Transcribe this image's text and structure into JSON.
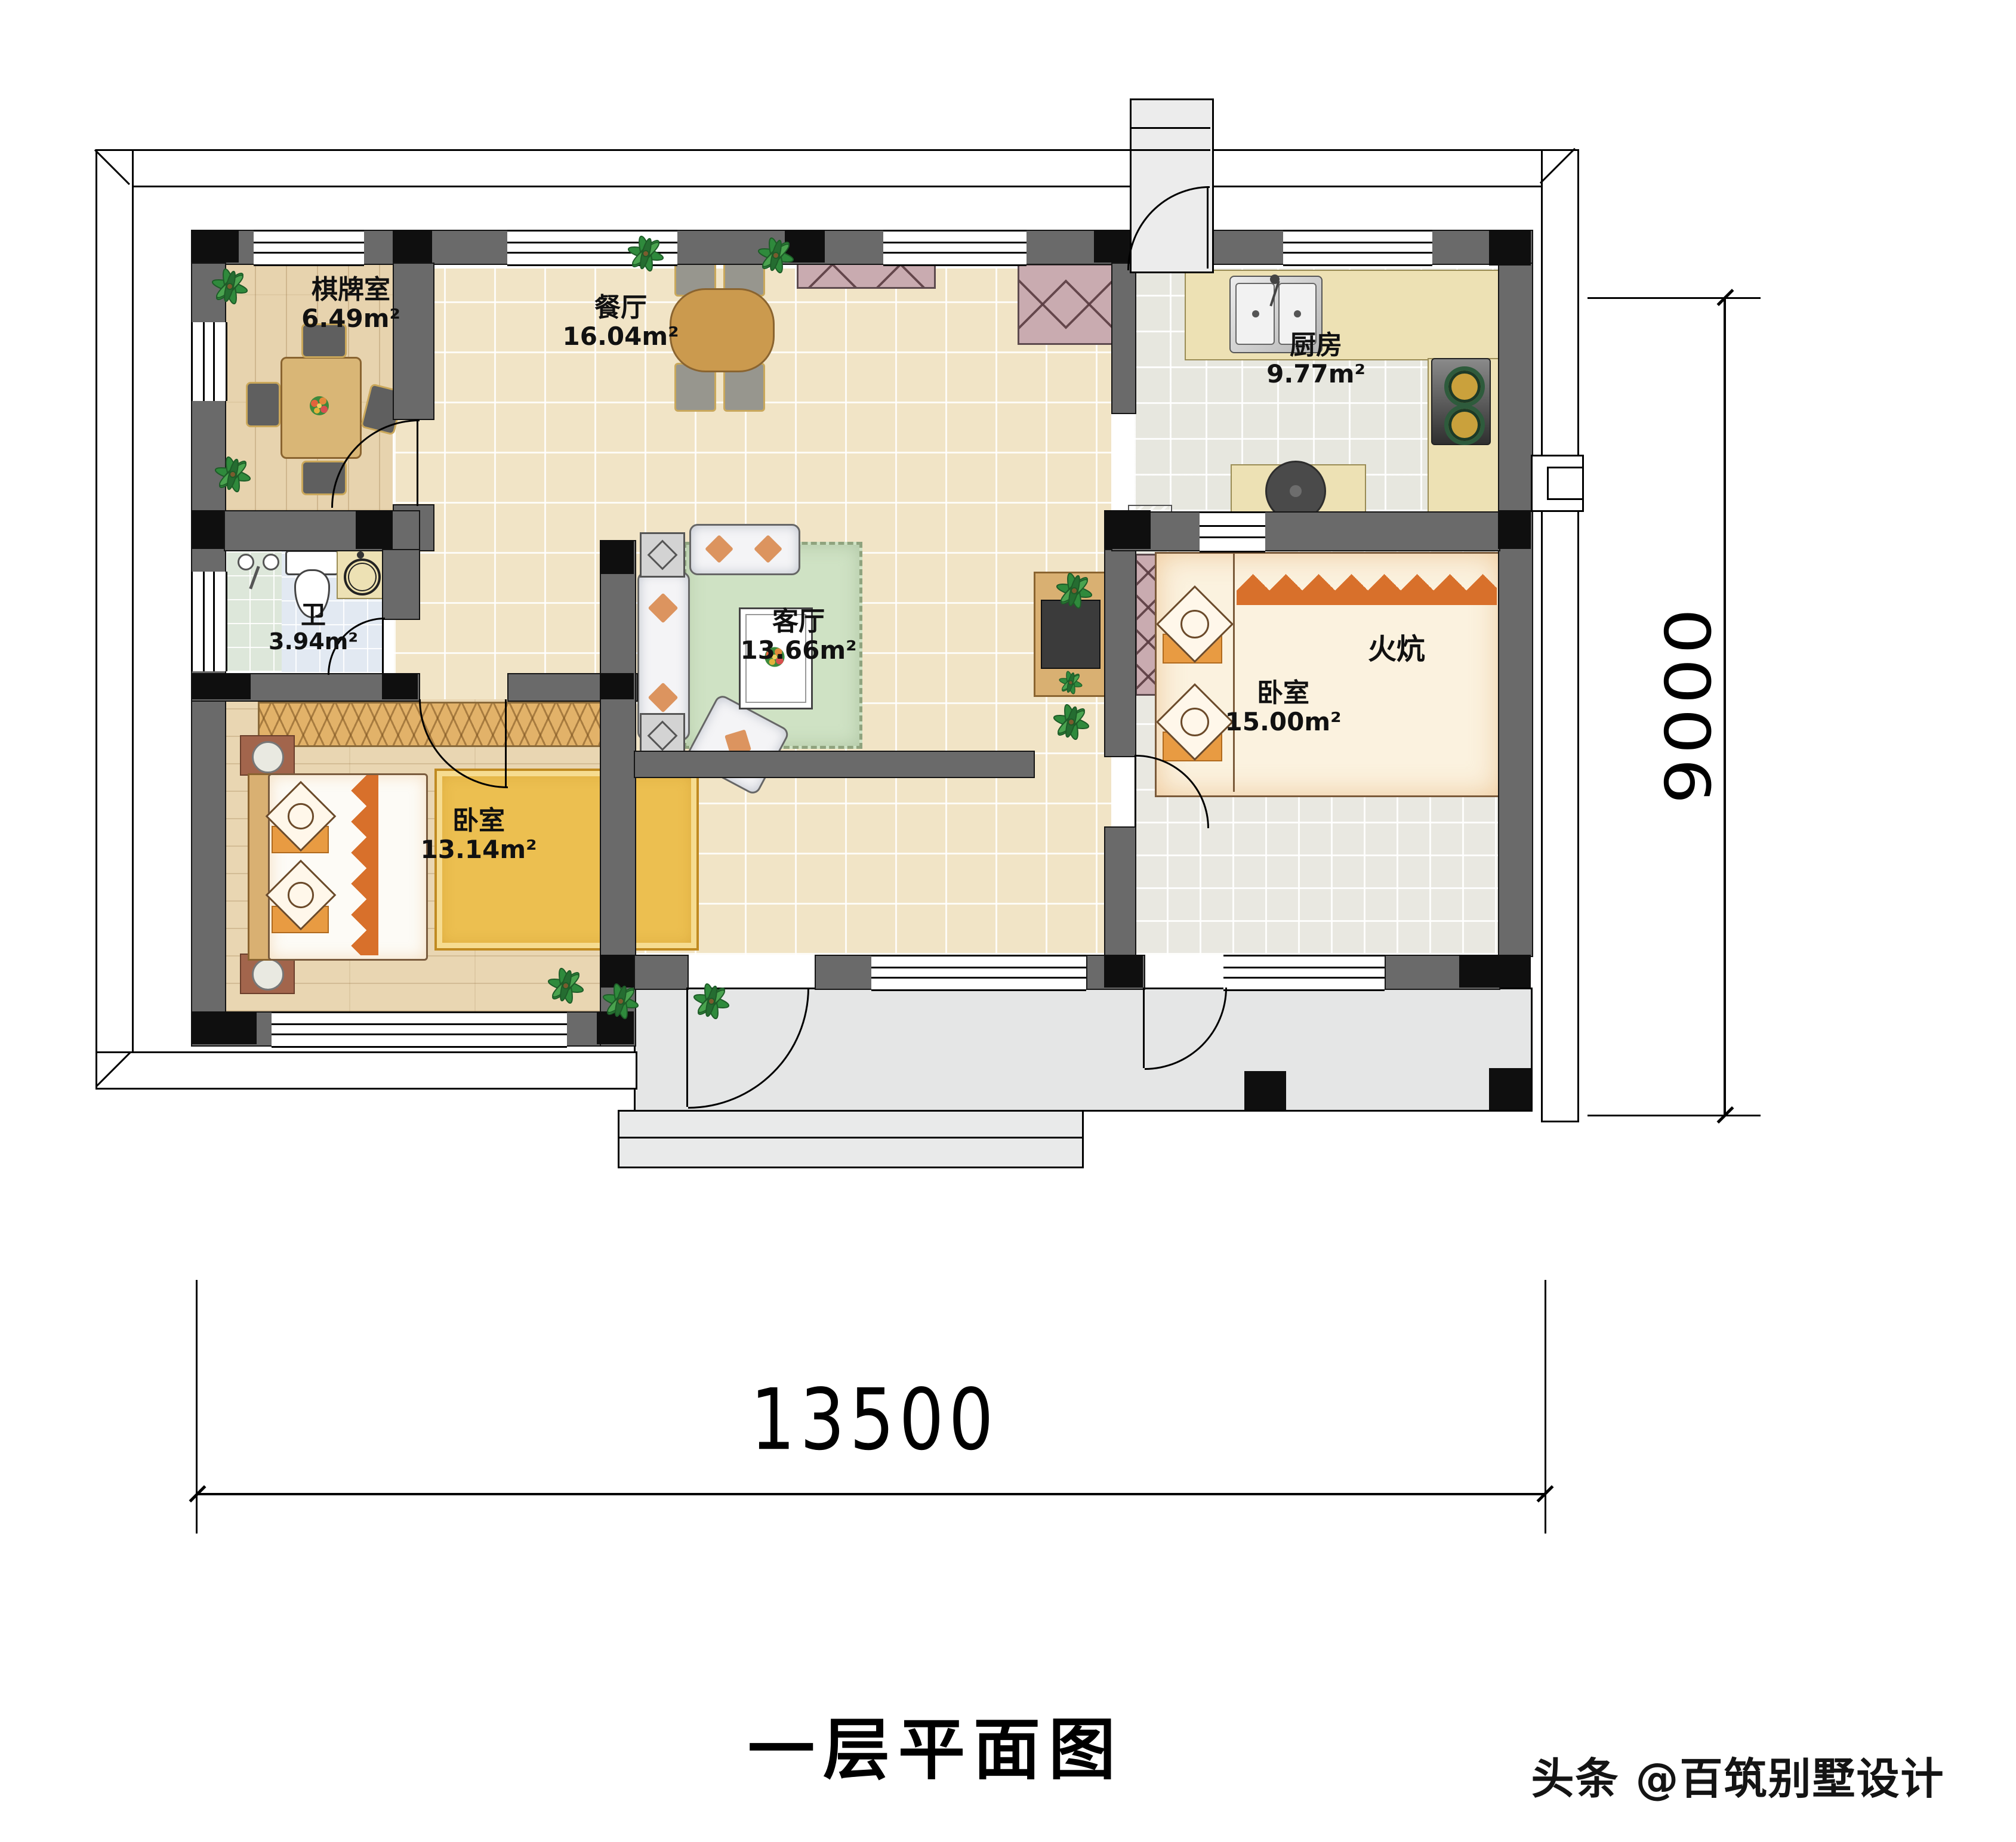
{
  "page": {
    "title": "一层平面图",
    "watermark": "头条 @百筑别墅设计"
  },
  "dimensions": {
    "horizontal": "13500",
    "vertical": "9000"
  },
  "rooms": [
    {
      "name": "棋牌室",
      "area": "6.49m²"
    },
    {
      "name": "餐厅",
      "area": "16.04m²"
    },
    {
      "name": "厨房",
      "area": "9.77m²"
    },
    {
      "name": "卫",
      "area": "3.94m²"
    },
    {
      "name": "客厅",
      "area": "13.66m²"
    },
    {
      "name": "卧室",
      "area": "13.14m²"
    },
    {
      "name": "卧室",
      "area": "15.00m²"
    }
  ],
  "features": {
    "kang": "火炕"
  },
  "colors": {
    "wall": "#6a6a6a",
    "column": "#0f0f0f",
    "tile": "#f1e4c6",
    "wood": "#e7d3ae",
    "kang_accent": "#d8702b",
    "cabinet": "#c9abb0"
  }
}
